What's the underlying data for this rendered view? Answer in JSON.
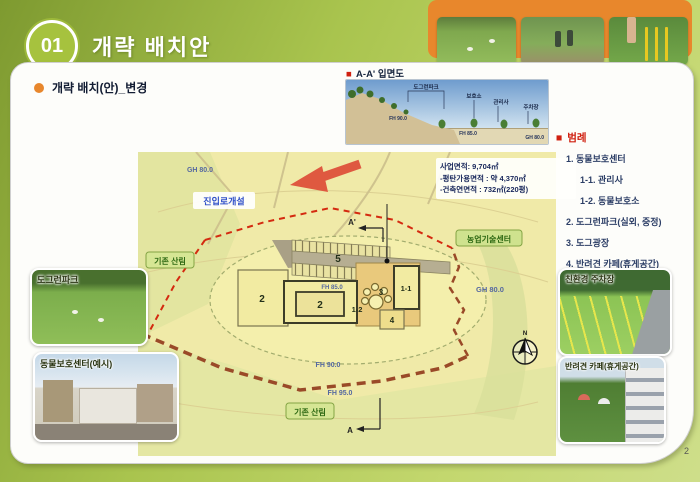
{
  "header": {
    "number": "01",
    "title": "개략 배치안"
  },
  "subtitle": "개략 배치(안)_변경",
  "icons": {
    "bullet_square": "■"
  },
  "elevation": {
    "title": "A-A' 입면도",
    "labels": {
      "l1": "도그런파크",
      "l2": "보호소",
      "l3": "관리사",
      "l4": "주차장",
      "fh90": "FH 90.0",
      "fh85": "FH 85.0",
      "gh80": "GH 80.0"
    }
  },
  "legend": {
    "title": "범례",
    "items": [
      {
        "label": "1. 동물보호센터"
      },
      {
        "label": "1-1. 관리사"
      },
      {
        "label": "1-2. 동물보호소"
      },
      {
        "label": "2. 도그런파크(실외, 중정)"
      },
      {
        "label": "3. 도그광장"
      },
      {
        "label": "4. 반려견 카페(휴게공간)"
      },
      {
        "label": "5. 주차장"
      }
    ]
  },
  "map": {
    "area_box": {
      "line1": "사업면적: 9,704㎡",
      "line2": "-평탄가용면적 : 약 4,370㎡",
      "line3": "-건축연면적 : 732㎡(220평)"
    },
    "labels": {
      "access_road": "진입로개설",
      "forest_left": "기존 산림",
      "forest_bottom": "기존 산림",
      "agri_center": "농업기술센터",
      "gh80": "GH 80.0",
      "gh80_top": "GH 80.0",
      "fh90": "FH 90.0",
      "fh95": "FH 95.0",
      "fh85": "FH 85.0",
      "a": "A",
      "a_prime": "A'",
      "north": "N"
    },
    "buildings": {
      "b5": "5",
      "b2a": "2",
      "b2b": "2",
      "b12": "1-2",
      "b3": "3",
      "b11": "1-1",
      "b4": "4"
    }
  },
  "photos": {
    "dogrun": "도그런파크",
    "animal_center": "동물보호센터(예시)",
    "eco_parking": "친환경 주차장",
    "pet_cafe": "반려견 카페(휴게공간)"
  },
  "footer": {
    "page": "2"
  },
  "colors": {
    "header_green": "#9ebf3f",
    "accent_orange": "#e8872c",
    "legend_red": "#d02010",
    "boundary_red": "#d42a10",
    "road_brown": "#9a4a28",
    "map_bg": "#f0eaa8"
  }
}
